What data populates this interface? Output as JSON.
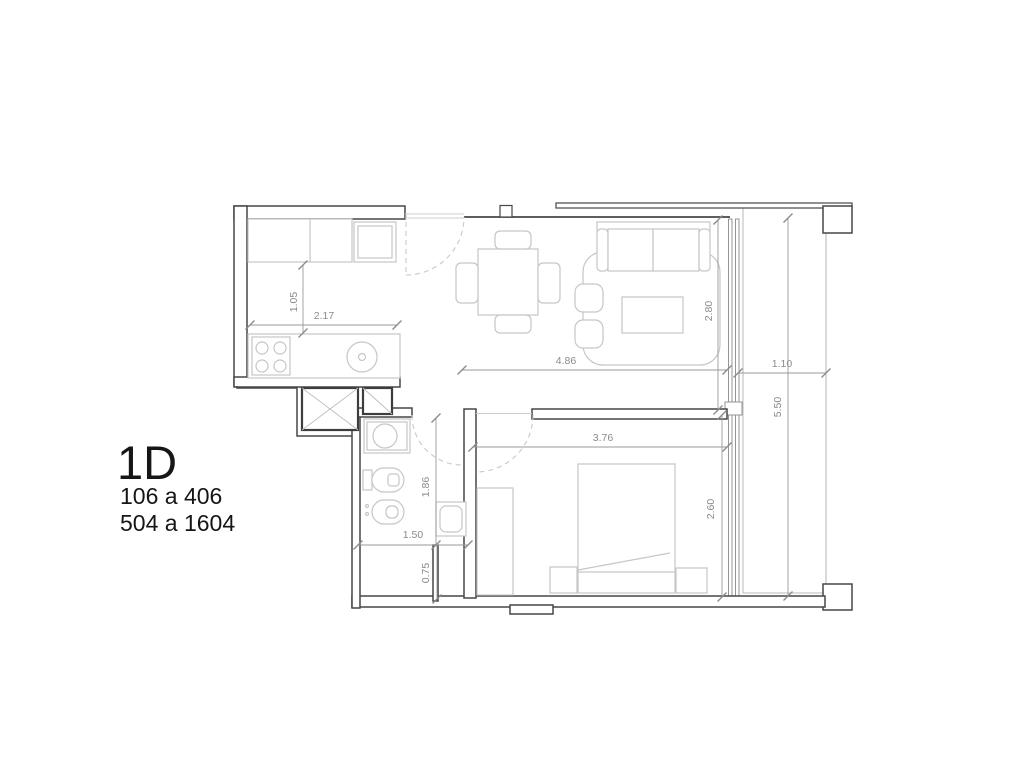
{
  "unit": {
    "code": "1D",
    "floors_line1": "106 a 406",
    "floors_line2": "504 a 1604"
  },
  "dimensions": {
    "kitchen_depth": "1.05",
    "kitchen_width": "2.17",
    "living_width": "4.86",
    "living_depth": "2.80",
    "balcony_width": "1.10",
    "balcony_length": "5.50",
    "bedroom_width": "3.76",
    "bedroom_depth": "2.60",
    "bathroom_length": "1.86",
    "bathroom_width": "1.50",
    "bathroom_extra": "0.75"
  },
  "colors": {
    "wall": "#474747",
    "furniture": "#c6c6c6",
    "dimension": "#8a8a8a",
    "deck_line": "#dcdcdc",
    "label_text": "#161616"
  }
}
